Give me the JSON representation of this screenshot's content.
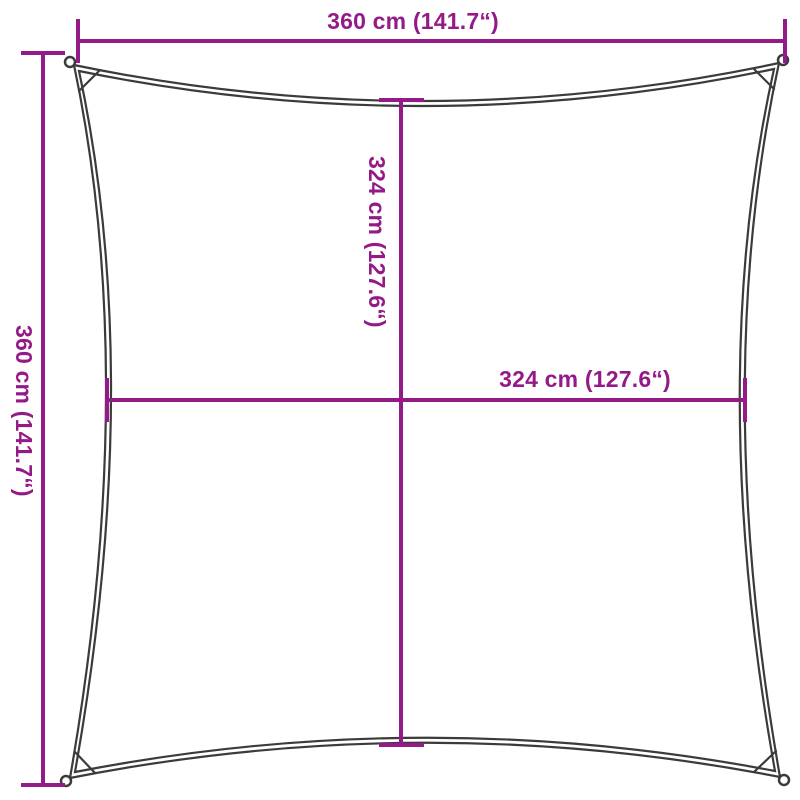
{
  "diagram": {
    "title": "square-shade-sail-dimension-diagram",
    "colors": {
      "dimension_accent": "#941a87",
      "outline": "#3b3b3b",
      "background": "#ffffff"
    },
    "dimensions": {
      "outer_width": {
        "cm": 360,
        "inches": 141.7,
        "label": "360 cm (141.7“)"
      },
      "outer_height": {
        "cm": 360,
        "inches": 141.7,
        "label": "360 cm (141.7“)"
      },
      "inner_height": {
        "cm": 324,
        "inches": 127.6,
        "label": "324 cm (127.6“)"
      },
      "inner_width": {
        "cm": 324,
        "inches": 127.6,
        "label": "324 cm (127.6“)"
      }
    }
  }
}
